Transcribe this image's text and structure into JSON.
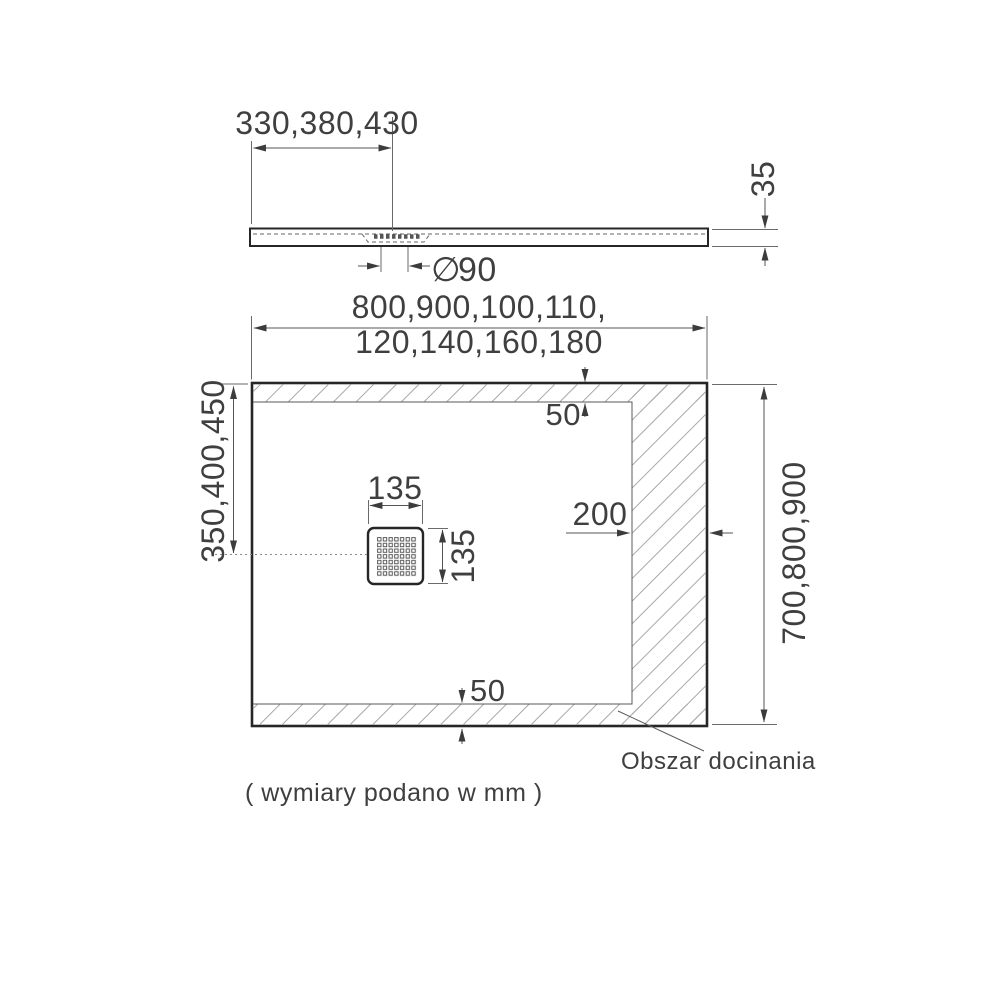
{
  "drawing": {
    "caption": "( wymiary podano w mm )",
    "side_view": {
      "drain_offset_widths": "330,380,430",
      "thickness": "35",
      "drain_diameter_symbol": "∅",
      "drain_diameter_value": "90"
    },
    "plan_view": {
      "widths_line1": "800,900,100,110,",
      "widths_line2": "120,140,160,180",
      "lengths": "700,800,900",
      "drain_offset_lengths": "350,400,450",
      "drain_width": "135",
      "drain_length": "135",
      "margin_top": "50",
      "margin_bottom": "50",
      "margin_right": "200",
      "trim_area_label": "Obszar docinania"
    },
    "colors": {
      "line_thick": "#262626",
      "line_thin": "#5a5a5a",
      "hatch": "#a8a8a8",
      "text": "#3f3f3f",
      "background": "#ffffff"
    }
  }
}
